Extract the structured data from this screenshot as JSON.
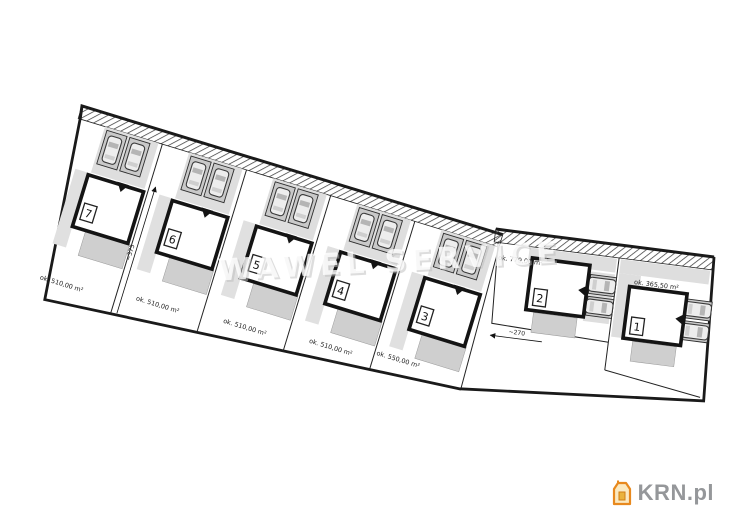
{
  "watermark": {
    "text": "WAWEL SERVICE"
  },
  "logo": {
    "text": "KRN.pl",
    "icon": "house-icon",
    "colors": {
      "outline": "#e8891e",
      "fill": "#fbe9c0",
      "text": "#95979a"
    }
  },
  "plan": {
    "road": {
      "style": "hatched-strip"
    },
    "dimensions": {
      "depth": "~375",
      "width": "~270"
    },
    "plots": [
      {
        "number": "7",
        "area": "ok. 510,00 m²"
      },
      {
        "number": "6",
        "area": "ok. 510,00 m²"
      },
      {
        "number": "5",
        "area": "ok. 510,00 m²"
      },
      {
        "number": "4",
        "area": "ok. 510,00 m²"
      },
      {
        "number": "3",
        "area": "ok. 550,00 m²"
      },
      {
        "number": "2",
        "area": "ok. 779,00 m²"
      },
      {
        "number": "1",
        "area": "ok. 365,50 m²"
      }
    ],
    "colors": {
      "paving": "#dedede",
      "wall": "#141414",
      "boundary": "#1a1a1a"
    }
  }
}
